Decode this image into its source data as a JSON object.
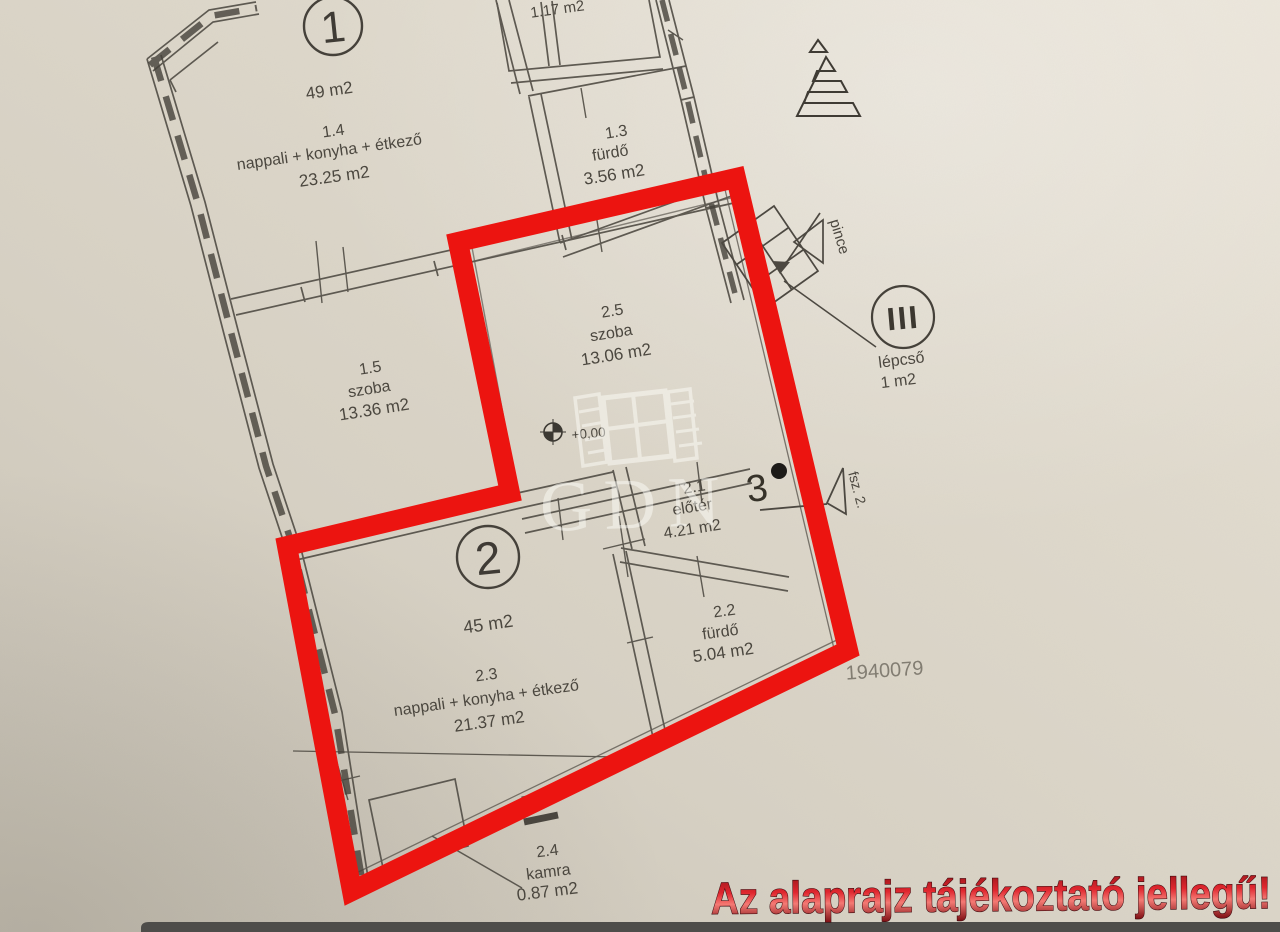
{
  "page": {
    "warning": "Az alaprajz tájékoztató jellegű!",
    "plan_number": "1940079",
    "watermark_text": "GDN",
    "colors": {
      "highlight_red": "#ec1410",
      "warning_red": "#d8232c",
      "paper": "#ddd7ca",
      "ink": "#4b473f"
    }
  },
  "north_symbol": {
    "label": "É"
  },
  "unit_badges": [
    {
      "number": "1",
      "area": "49 m2"
    },
    {
      "number": "2",
      "area": "45 m2"
    }
  ],
  "rooms": [
    {
      "number": "",
      "name": "",
      "area": "1.17 m2"
    },
    {
      "number": "1.3",
      "name": "fürdő",
      "area": "3.56 m2"
    },
    {
      "number": "1.4",
      "name": "nappali + konyha + étkező",
      "area": "23.25 m2"
    },
    {
      "number": "1.5",
      "name": "szoba",
      "area": "13.36 m2"
    },
    {
      "number": "2.5",
      "name": "szoba",
      "area": "13.06 m2"
    },
    {
      "number": "2.1",
      "name": "előtér",
      "area": "4.21 m2"
    },
    {
      "number": "2.2",
      "name": "fürdő",
      "area": "5.04 m2"
    },
    {
      "number": "2.3",
      "name": "nappali + konyha + étkező",
      "area": "21.37 m2"
    },
    {
      "number": "2.4",
      "name": "kamra",
      "area": "0.87 m2"
    }
  ],
  "stairs": {
    "symbol": "III",
    "name": "lépcső",
    "area": "1 m2",
    "basement_label": "pince",
    "floor_label": "fsz. 2.",
    "level_mark": "3"
  },
  "elevation_marker": {
    "label": "+0,00"
  }
}
